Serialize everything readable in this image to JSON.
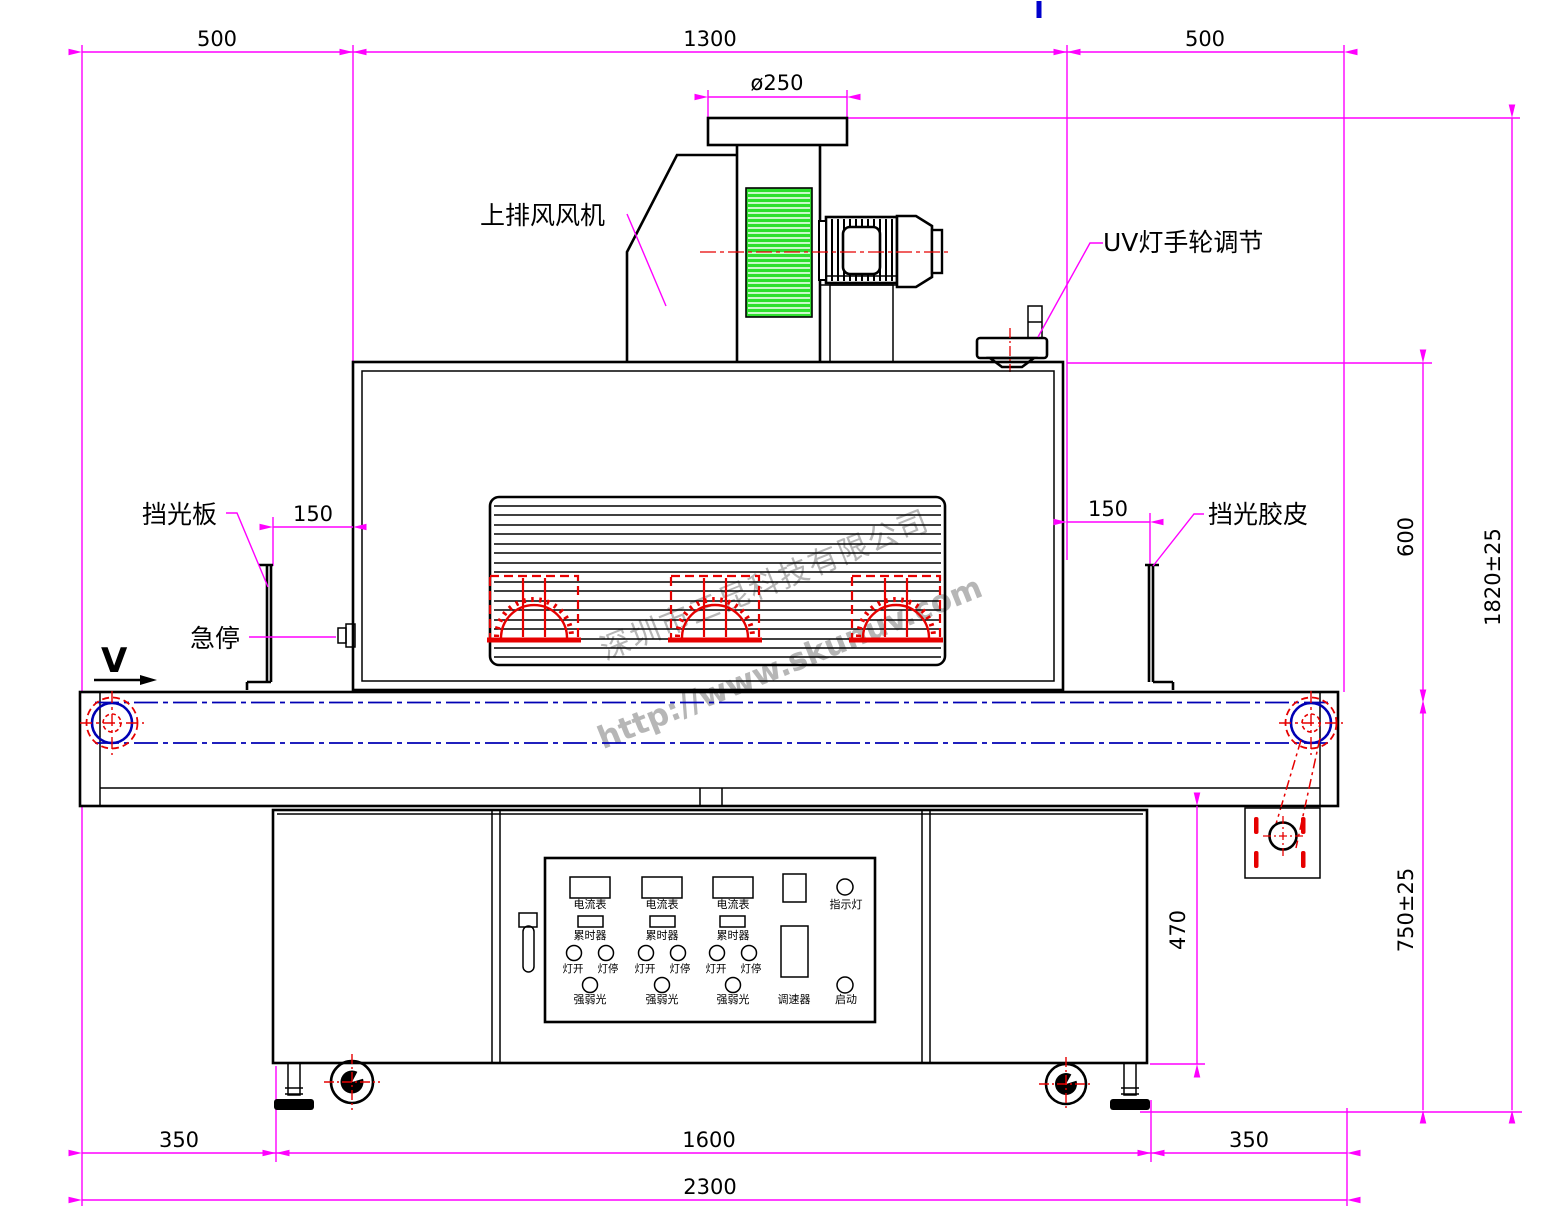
{
  "drawing": {
    "labels": {
      "top_fan": "上排风风机",
      "uv_handwheel": "UV灯手轮调节",
      "shield_plate": "挡光板",
      "emergency_stop": "急停",
      "shield_rubber": "挡光胶皮",
      "direction": "V"
    },
    "dimensions": {
      "top_left": "500",
      "top_center": "1300",
      "top_right": "500",
      "duct_diameter": "ø250",
      "left_gap": "150",
      "right_gap": "150",
      "lamp_house_height": "600",
      "total_height": "1820±25",
      "conveyor_height": "750±25",
      "cabinet_height": "470",
      "bottom_left": "350",
      "bottom_center": "1600",
      "bottom_right": "350",
      "total_length": "2300"
    },
    "control_panel": {
      "ammeter": "电流表",
      "timer": "累时器",
      "lamp_on": "灯开",
      "lamp_off": "灯停",
      "light_level": "强弱光",
      "indicator": "指示灯",
      "speed": "调速器",
      "start": "启动"
    },
    "watermark": {
      "company": "深圳市三昆科技有限公司",
      "website": "http://www.skunuv.com"
    },
    "colors": {
      "dimension": "#ff00ff",
      "centerline_blue": "#0000b4",
      "highlight_red": "#e60000",
      "fan_green": "#2ee02e",
      "line_black": "#000000"
    }
  }
}
